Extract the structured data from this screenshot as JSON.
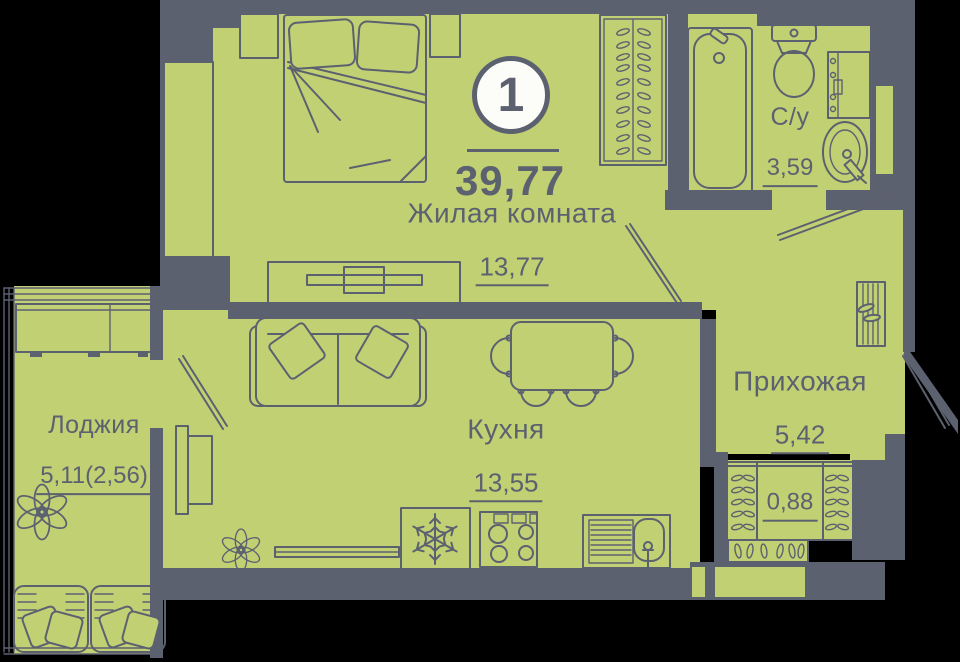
{
  "colors": {
    "room_fill": "#c2d074",
    "wall": "#5c6170",
    "badge_bg": "#fcfcf8",
    "background": "#000000"
  },
  "plan": {
    "room_count": "1",
    "total_area": "39,77"
  },
  "rooms": {
    "living": {
      "name": "Жилая комната",
      "area": "13,77"
    },
    "kitchen": {
      "name": "Кухня",
      "area": "13,55"
    },
    "loggia": {
      "name": "Лоджия",
      "area": "5,11(2,56)"
    },
    "hallway": {
      "name": "Прихожая",
      "area": "5,42"
    },
    "bathroom": {
      "name": "С/у",
      "area": "3,59"
    },
    "closet": {
      "area": "0,88"
    }
  },
  "furniture": [
    "bed",
    "nightstand",
    "wardrobe-with-hangers",
    "tv-stand",
    "sofa",
    "dining-table-with-chairs",
    "fridge",
    "stove",
    "kitchen-sink",
    "radiator",
    "plant",
    "loggia-cabinet",
    "armchair",
    "bathtub",
    "toilet",
    "washing-machine",
    "washbasin",
    "shoe-rack",
    "closet-hangers",
    "door-swing"
  ]
}
